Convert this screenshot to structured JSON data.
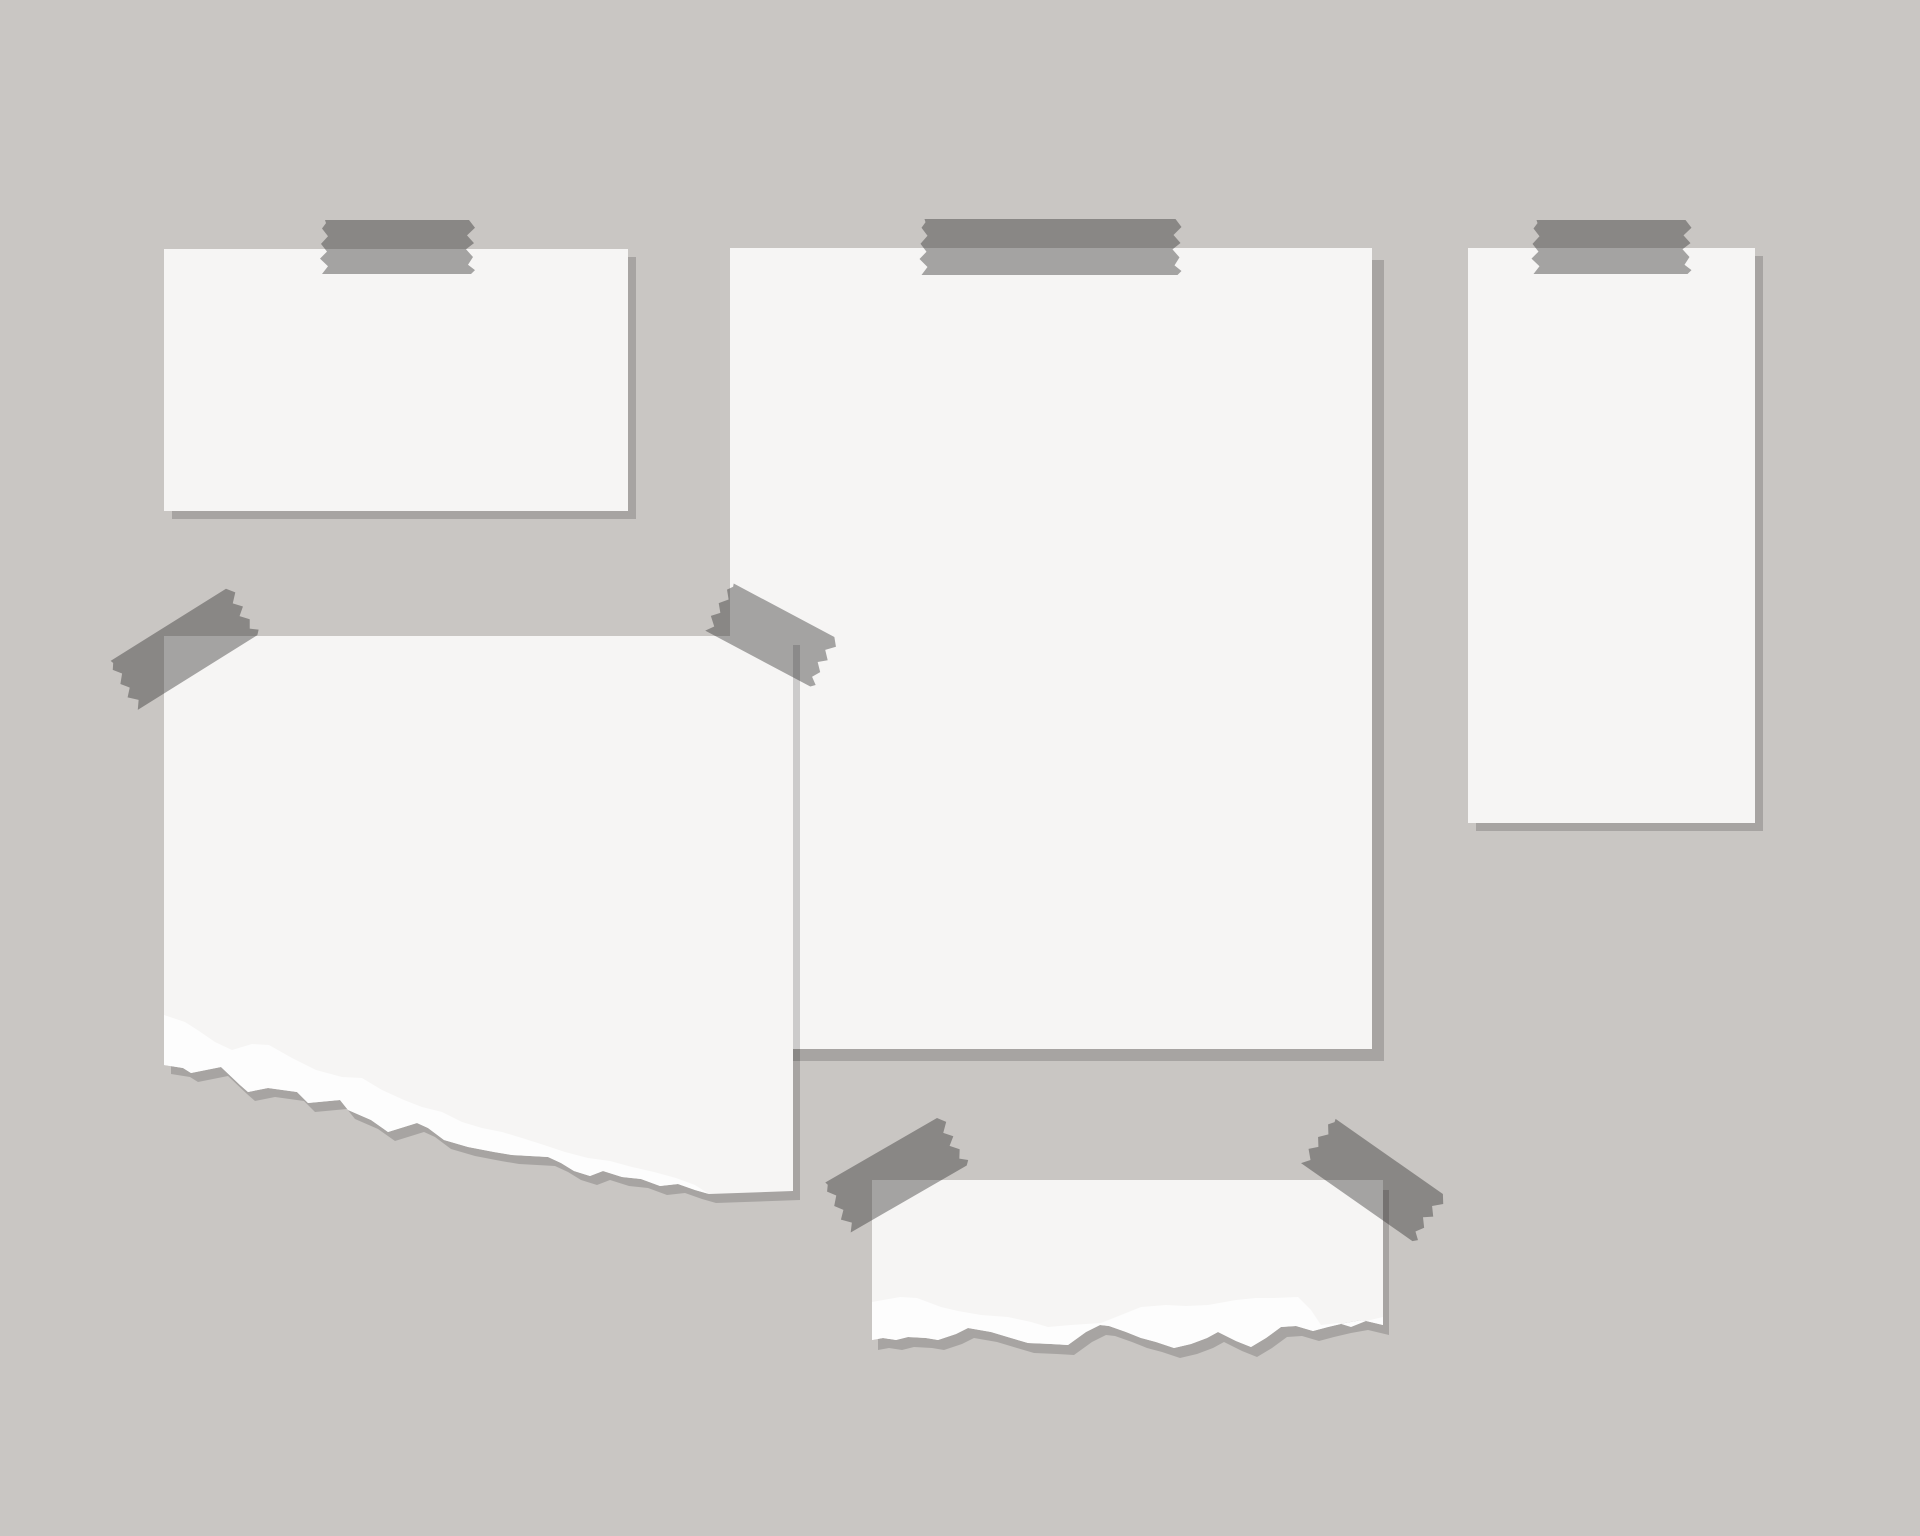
{
  "scene": {
    "title": "blank-papers-taped-to-wall-moodboard",
    "canvas": {
      "width": 1920,
      "height": 1536
    },
    "colors": {
      "background": "#c9c6c3",
      "paper": "#f6f5f4",
      "tear_white": "#fdfdfd",
      "shadow": "rgba(0,0,0,0.17)",
      "tape": "#2b2928",
      "tape_opacity": 0.4
    },
    "papers": [
      {
        "name": "paper-top-left-landscape",
        "body": "164,249 628,249 628,511 164,511",
        "shadow_offset": [
          8,
          8
        ],
        "tapes": [
          {
            "name": "tape-paper-top-left",
            "cx": 398,
            "cy": 247,
            "rotate": 0,
            "length": 158,
            "width": 54
          }
        ]
      },
      {
        "name": "paper-right-tall-portrait",
        "body": "1468,248 1755,248 1755,823 1468,823",
        "shadow_offset": [
          8,
          8
        ],
        "tapes": [
          {
            "name": "tape-paper-right",
            "cx": 1612,
            "cy": 247,
            "rotate": 0,
            "length": 163,
            "width": 54
          }
        ]
      },
      {
        "name": "paper-center-large",
        "body": "730,248 1372,248 1372,1049 730,1049",
        "shadow_offset": [
          12,
          12
        ],
        "tapes": [
          {
            "name": "tape-paper-center",
            "cx": 1051,
            "cy": 247,
            "rotate": 0,
            "length": 265,
            "width": 56
          }
        ]
      },
      {
        "name": "paper-middle-left-torn",
        "body": "164,636 793,636 793,1191 709,1194 695,1190 678,1184 660,1186 641,1179 622,1177 603,1171 590,1176 574,1171 561,1163 548,1157 512,1155 494,1152 468,1147 444,1140 428,1128 417,1123 388,1132 371,1120 348,1110 340,1100 308,1103 297,1092 268,1088 248,1092 240,1085 221,1067 191,1073 183,1068 164,1065",
        "tear_strip": "164,1015 185,1022 199,1031 215,1042 232,1050 252,1044 269,1045 292,1058 316,1070 342,1077 362,1078 382,1090 404,1100 422,1107 442,1112 462,1122 482,1128 502,1132 522,1138 544,1145 565,1152 588,1158 610,1161 632,1167 654,1172 676,1178 695,1185 709,1194 695,1190 678,1184 660,1186 641,1179 622,1177 603,1171 590,1176 574,1171 561,1163 548,1157 512,1155 494,1152 468,1147 444,1140 428,1128 417,1123 388,1132 371,1120 348,1110 340,1100 308,1103 297,1092 268,1088 248,1092 240,1085 221,1067 191,1073 183,1068 164,1065",
        "shadow_offset": [
          7,
          9
        ],
        "tapes": [
          {
            "name": "tape-torn-left-corner-left",
            "cx": 184,
            "cy": 648,
            "rotate": -32,
            "length": 150,
            "width": 56
          },
          {
            "name": "tape-torn-left-corner-right",
            "cx": 772,
            "cy": 635,
            "rotate": 28,
            "length": 128,
            "width": 55
          }
        ]
      },
      {
        "name": "paper-bottom-middle-torn",
        "body": "872,1180 1383,1180 1383,1325 1362,1320 1345,1323 1328,1327 1313,1331 1296,1326 1281,1327 1266,1338 1251,1347 1236,1341 1218,1332 1207,1338 1191,1344 1174,1348 1156,1342 1141,1338 1126,1332 1109,1326 1100,1325 1086,1332 1068,1345 1051,1344 1028,1343 1011,1338 991,1332 968,1328 956,1334 938,1340 926,1338 908,1337 896,1340 883,1338 872,1340",
        "tear_strip": "872,1302 900,1297 917,1298 941,1307 958,1311 981,1315 1008,1317 1031,1322 1048,1327 1071,1325 1101,1323 1121,1315 1141,1307 1166,1305 1186,1306 1208,1305 1236,1300 1256,1298 1274,1298 1298,1297 1311,1310 1321,1325 1338,1323 1351,1327 1366,1321 1383,1317 1383,1325 1362,1320 1345,1323 1328,1327 1313,1331 1296,1326 1281,1327 1266,1338 1251,1347 1236,1341 1218,1332 1207,1338 1191,1344 1174,1348 1156,1342 1141,1338 1126,1332 1109,1326 1100,1325 1086,1332 1068,1345 1051,1344 1028,1343 1011,1338 991,1332 968,1328 956,1334 938,1340 926,1338 908,1337 896,1340 883,1338 872,1340",
        "shadow_offset": [
          6,
          10
        ],
        "tapes": [
          {
            "name": "tape-torn-bottom-corner-left",
            "cx": 896,
            "cy": 1174,
            "rotate": -30,
            "length": 143,
            "width": 56
          },
          {
            "name": "tape-torn-bottom-corner-right",
            "cx": 1374,
            "cy": 1180,
            "rotate": 35,
            "length": 145,
            "width": 56
          }
        ]
      }
    ]
  }
}
